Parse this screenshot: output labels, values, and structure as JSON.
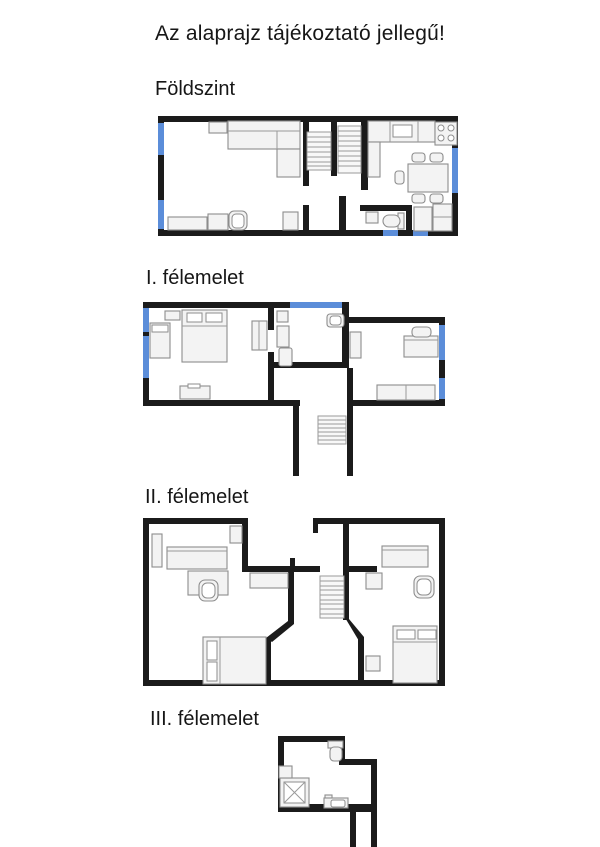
{
  "title": "Az alaprajz tájékoztató jellegű!",
  "floors": [
    {
      "label": "Földszint",
      "depicted_items": [
        "corner-sofa",
        "side-table",
        "sideboard",
        "coffee-table",
        "armchair",
        "cabinet",
        "double-staircase",
        "kitchen-counter",
        "kitchen-sink",
        "stove",
        "dining-table",
        "chairs",
        "wc-sink",
        "toilet",
        "storage-cabinets"
      ]
    },
    {
      "label": "I. félemelet",
      "depicted_items": [
        "double-bed",
        "single-bed",
        "nightstand",
        "wardrobe",
        "dresser",
        "bathroom-sink",
        "shelf",
        "washing-machine",
        "toilet",
        "desk",
        "desk-chair",
        "long-dresser",
        "staircase"
      ]
    },
    {
      "label": "II. félemelet",
      "depicted_items": [
        "tall-cabinet",
        "desk",
        "table",
        "chair",
        "shelf",
        "hall-cabinet",
        "double-bed-left",
        "staircase",
        "desk-right",
        "chair-right",
        "small-cabinet",
        "nightstand",
        "double-bed-right"
      ]
    },
    {
      "label": "III. félemelet",
      "depicted_items": [
        "shower",
        "wash-basin",
        "toilet",
        "sink",
        "stair-corridor"
      ]
    }
  ],
  "colors": {
    "background": "#ffffff",
    "text": "#161616",
    "wall": "#1b1b1b",
    "window": "#5b8dd9",
    "furniture_fill": "#f3f3f3",
    "furniture_stroke": "#8d8d8d"
  }
}
